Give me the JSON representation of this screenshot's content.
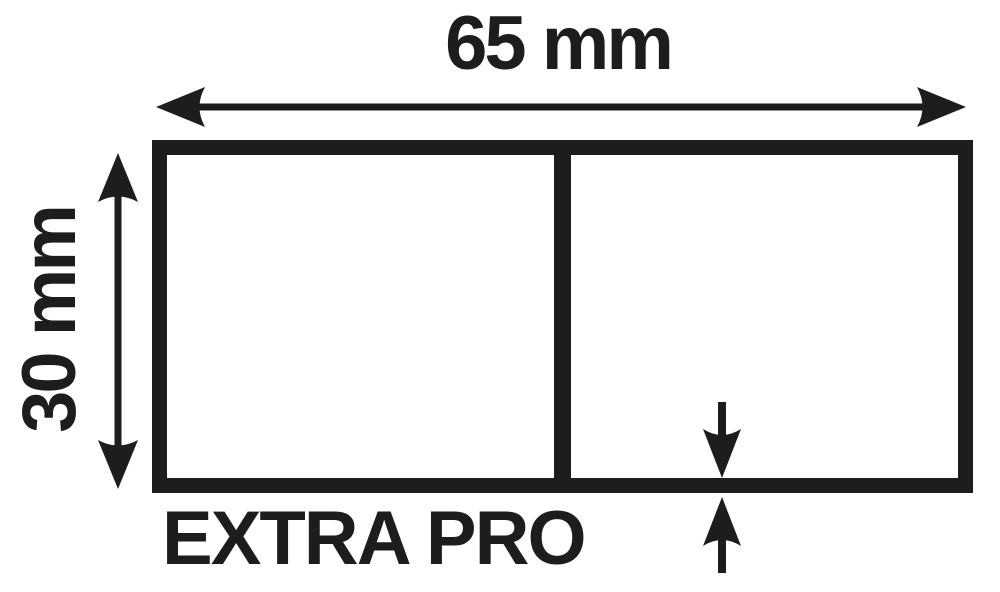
{
  "diagram": {
    "product_name": "EXTRA PRO",
    "dimensions": {
      "width_mm": 65,
      "height_mm": 30,
      "wall_thickness_mm": 1.8
    }
  },
  "labels": {
    "width": "65 mm",
    "height": "30 mm",
    "thickness": "1,8 mm",
    "product": "EXTRA PRO"
  },
  "colors": {
    "ink": "#1d1d1b",
    "background": "#ffffff"
  }
}
